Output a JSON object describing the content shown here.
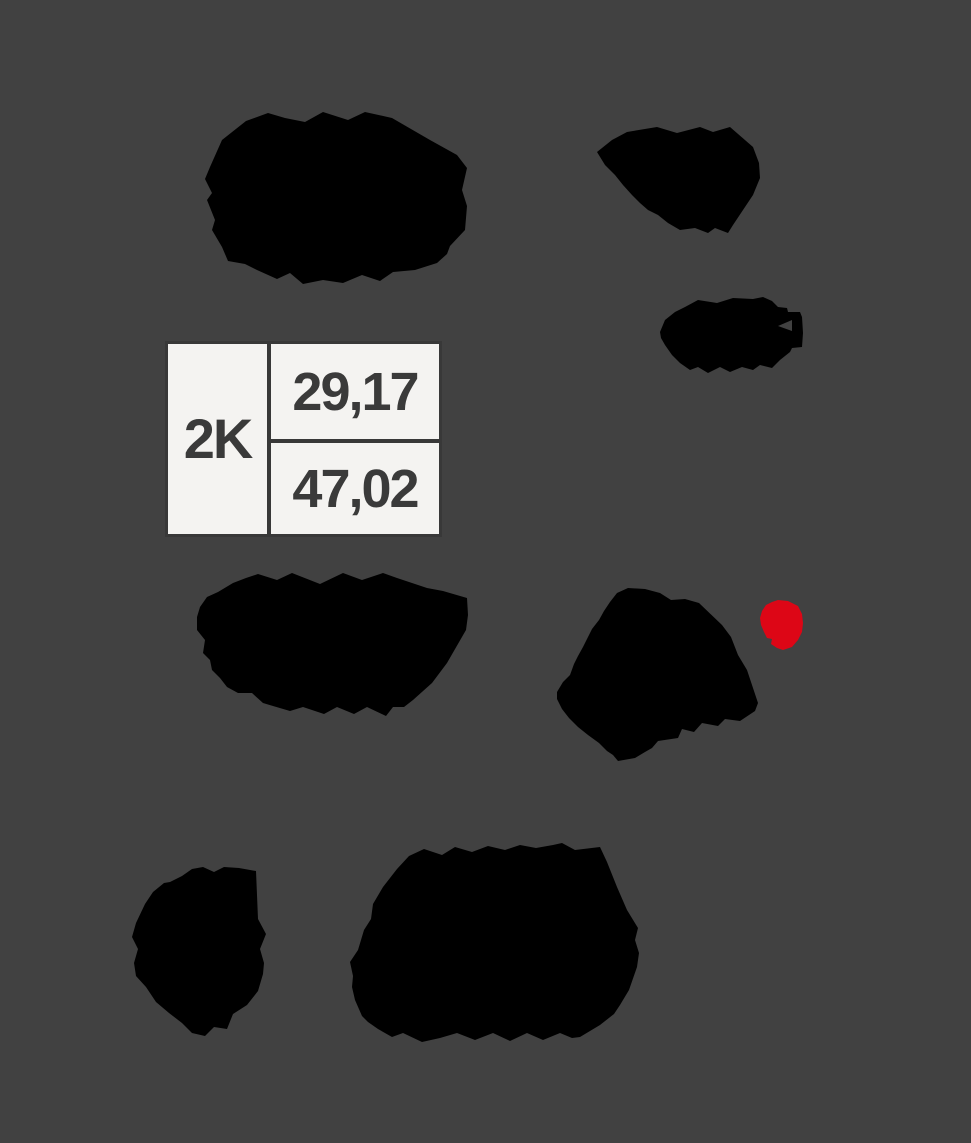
{
  "colors": {
    "background": "#414141",
    "blob_black": "#000000",
    "marker_red": "#dd0616",
    "cell_background": "#f4f3f1",
    "table_border": "#383838",
    "table_text": "#3a3a3a"
  },
  "zone_info_box": {
    "zone_label": "2K",
    "upper_value": "29,17",
    "lower_value": "47,02"
  },
  "marker": {
    "description": "red-dot-marker"
  }
}
